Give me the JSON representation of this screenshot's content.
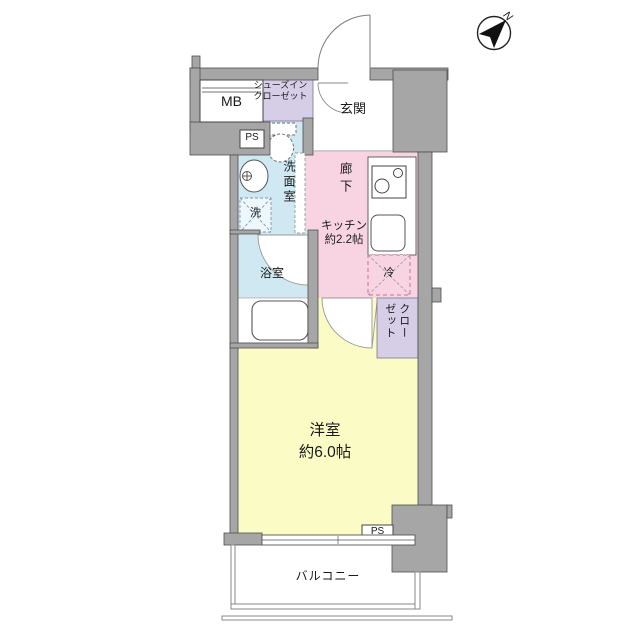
{
  "compass": {
    "north_label": "N"
  },
  "labels": {
    "meter_box": "MB",
    "shoe_closet_line1": "シューズイン",
    "shoe_closet_line2": "クローゼット",
    "entrance": "玄関",
    "pipe_space_top": "PS",
    "washroom": "洗面室",
    "washing_machine": "洗",
    "hallway": "廊下",
    "kitchen_name": "キッチン",
    "kitchen_size": "約2.2帖",
    "refrigerator": "冷",
    "bathroom": "浴室",
    "closet_col_right": "クロー",
    "closet_col_left": "ゼット",
    "western_room_name": "洋室",
    "western_room_size": "約6.0帖",
    "pipe_space_bottom": "PS",
    "balcony": "バルコニー"
  },
  "colors": {
    "wall": "#a6a6a6",
    "wall-line": "#4f4f4f",
    "room-yellow": "#fbfbc6",
    "room-pink": "#f8d4e2",
    "room-blue": "#cfe8f1",
    "room-lavender": "#d6cde7",
    "fixture-line": "#555555",
    "fridge-dash": "#c9729b",
    "thin-line": "#8a8a8a"
  }
}
